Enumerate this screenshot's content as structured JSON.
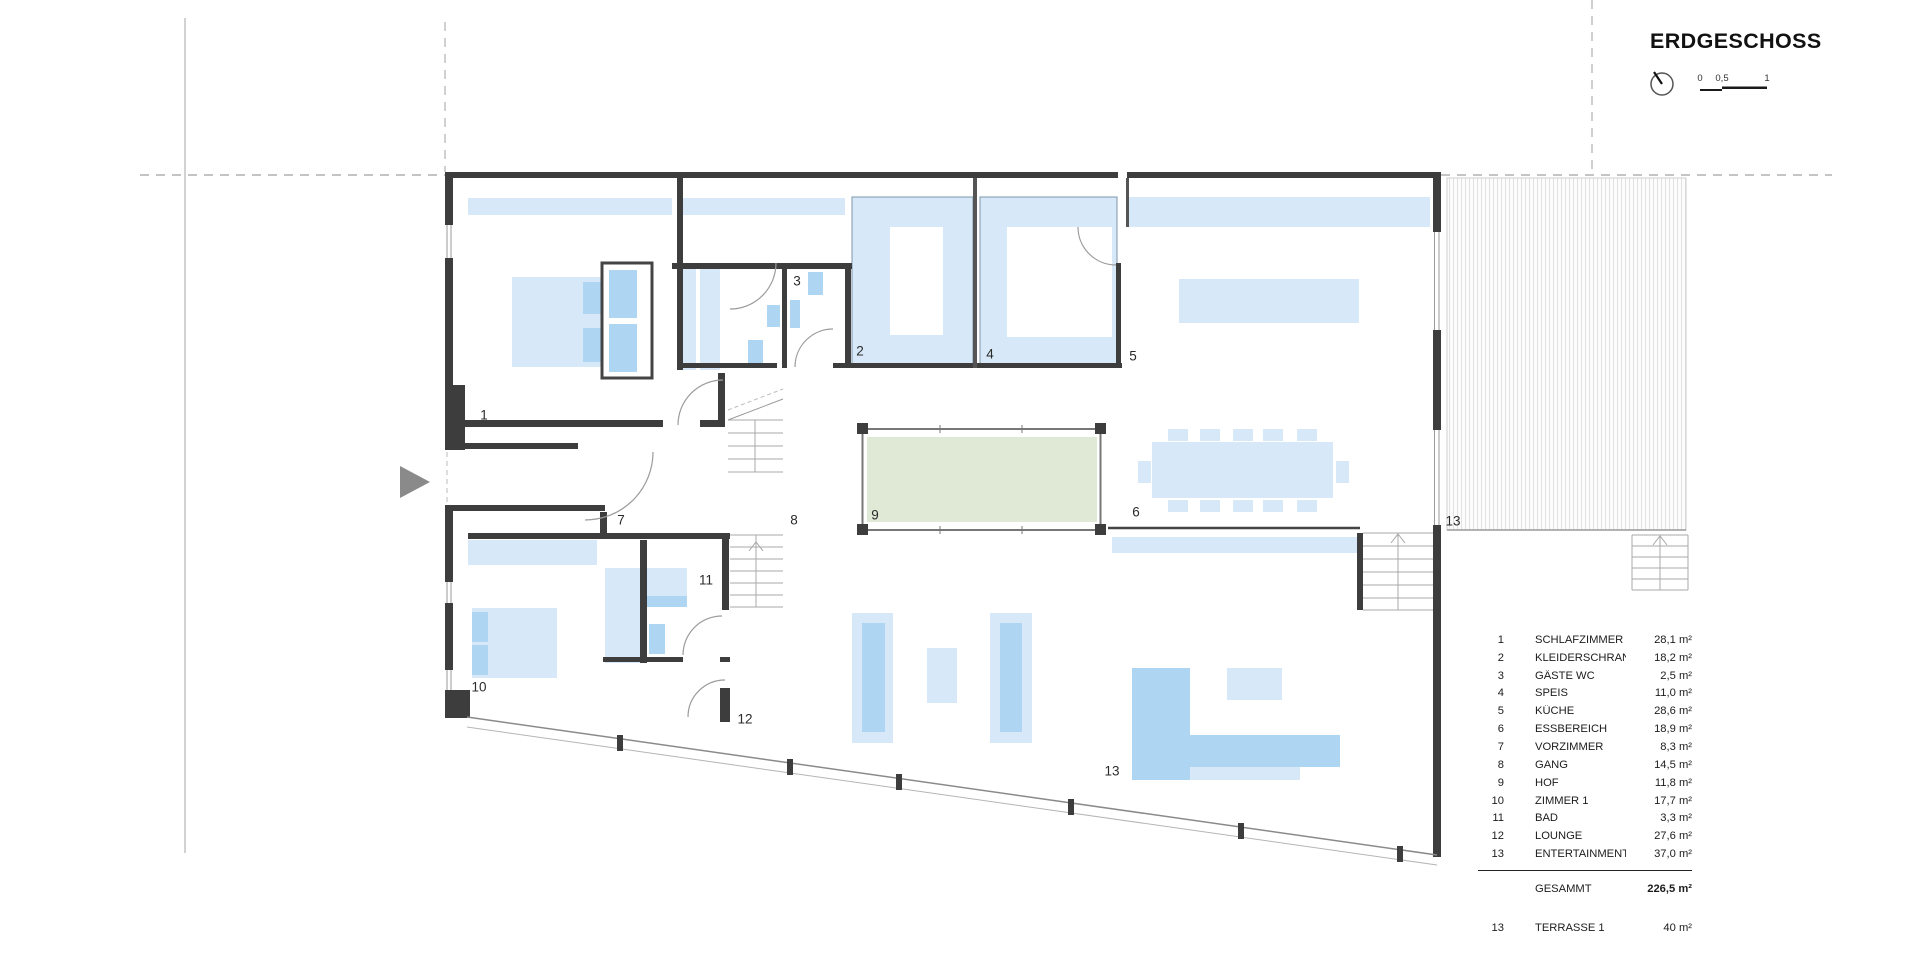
{
  "title": "ERDGESCHOSS",
  "scale_bar": {
    "labels": [
      "0",
      "0,5",
      "1"
    ]
  },
  "plan": {
    "room_labels": [
      {
        "num": "1",
        "name": "SCHLAFZIMMER",
        "x": 484,
        "y": 415
      },
      {
        "num": "2",
        "name": "KLEIDERSCHRANK",
        "x": 860,
        "y": 351
      },
      {
        "num": "3",
        "name": "GÄSTE WC",
        "x": 797,
        "y": 281
      },
      {
        "num": "4",
        "name": "SPEIS",
        "x": 990,
        "y": 354
      },
      {
        "num": "5",
        "name": "KÜCHE",
        "x": 1133,
        "y": 356
      },
      {
        "num": "6",
        "name": "ESSBEREICH",
        "x": 1136,
        "y": 512
      },
      {
        "num": "7",
        "name": "VORZIMMER",
        "x": 621,
        "y": 520
      },
      {
        "num": "8",
        "name": "GANG",
        "x": 794,
        "y": 520
      },
      {
        "num": "9",
        "name": "HOF",
        "x": 875,
        "y": 515
      },
      {
        "num": "10",
        "name": "ZIMMER 1",
        "x": 479,
        "y": 687
      },
      {
        "num": "11",
        "name": "BAD",
        "x": 706,
        "y": 580
      },
      {
        "num": "12",
        "name": "LOUNGE",
        "x": 745,
        "y": 719
      },
      {
        "num": "13",
        "name": "ENTERTAINMENT",
        "x": 1112,
        "y": 771
      },
      {
        "num": "13",
        "name": "TERRASSE 1",
        "x": 1453,
        "y": 521
      }
    ]
  },
  "legend": {
    "rows": [
      {
        "num": "1",
        "name": "SCHLAFZIMMER",
        "area": "28,1 m²"
      },
      {
        "num": "2",
        "name": "KLEIDERSCHRANK",
        "area": "18,2 m²"
      },
      {
        "num": "3",
        "name": "GÄSTE WC",
        "area": "2,5 m²"
      },
      {
        "num": "4",
        "name": "SPEIS",
        "area": "11,0 m²"
      },
      {
        "num": "5",
        "name": "KÜCHE",
        "area": "28,6 m²"
      },
      {
        "num": "6",
        "name": "ESSBEREICH",
        "area": "18,9 m²"
      },
      {
        "num": "7",
        "name": "VORZIMMER",
        "area": "8,3 m²"
      },
      {
        "num": "8",
        "name": "GANG",
        "area": "14,5 m²"
      },
      {
        "num": "9",
        "name": "HOF",
        "area": "11,8 m²"
      },
      {
        "num": "10",
        "name": "ZIMMER 1",
        "area": "17,7 m²"
      },
      {
        "num": "11",
        "name": "BAD",
        "area": "3,3 m²"
      },
      {
        "num": "12",
        "name": "LOUNGE",
        "area": "27,6 m²"
      },
      {
        "num": "13",
        "name": "ENTERTAINMENT",
        "area": "37,0 m²"
      }
    ],
    "total": {
      "label": "GESAMMT",
      "area": "226,5 m²"
    },
    "terrace": {
      "num": "13",
      "name": "TERRASSE 1",
      "area": "40 m²"
    }
  },
  "colors": {
    "wall": "#3d3d3d",
    "furniture_light": "#d7e9f8",
    "furniture_mid": "#aed5f2",
    "courtyard_green": "#dfe9d5",
    "hatch_line": "#e2e2e2"
  }
}
